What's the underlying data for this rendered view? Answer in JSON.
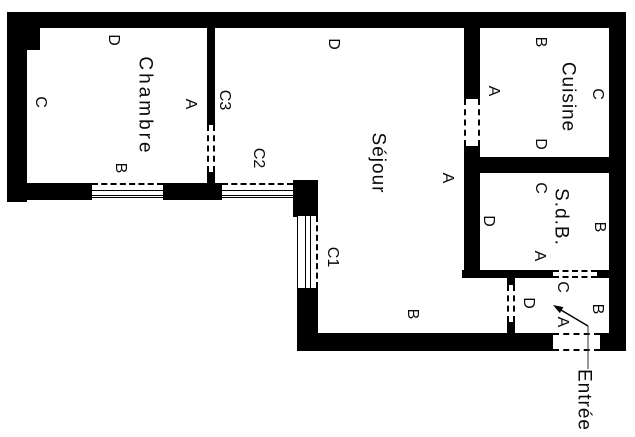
{
  "rooms": {
    "chambre": {
      "name": "Chambre",
      "walls": {
        "a": "A",
        "b": "B",
        "c": "C",
        "d": "D"
      }
    },
    "sejour": {
      "name": "Séjour",
      "walls": {
        "a": "A",
        "b": "B",
        "d": "D"
      }
    },
    "cuisine": {
      "name": "Cuisine",
      "walls": {
        "a": "A",
        "b": "B",
        "c": "C",
        "d": "D"
      }
    },
    "sdb": {
      "name": "S.d.B.",
      "walls": {
        "a": "A",
        "b": "B",
        "c": "C",
        "d": "D"
      }
    },
    "entree_hall": {
      "walls": {
        "a": "A",
        "b": "B",
        "c": "C",
        "d": "D"
      }
    }
  },
  "openings": {
    "c1": "C1",
    "c2": "C2",
    "c3": "C3"
  },
  "entrance": {
    "label": "Entrée"
  },
  "colors": {
    "wall": "#000000",
    "background": "#ffffff",
    "text": "#000000"
  }
}
